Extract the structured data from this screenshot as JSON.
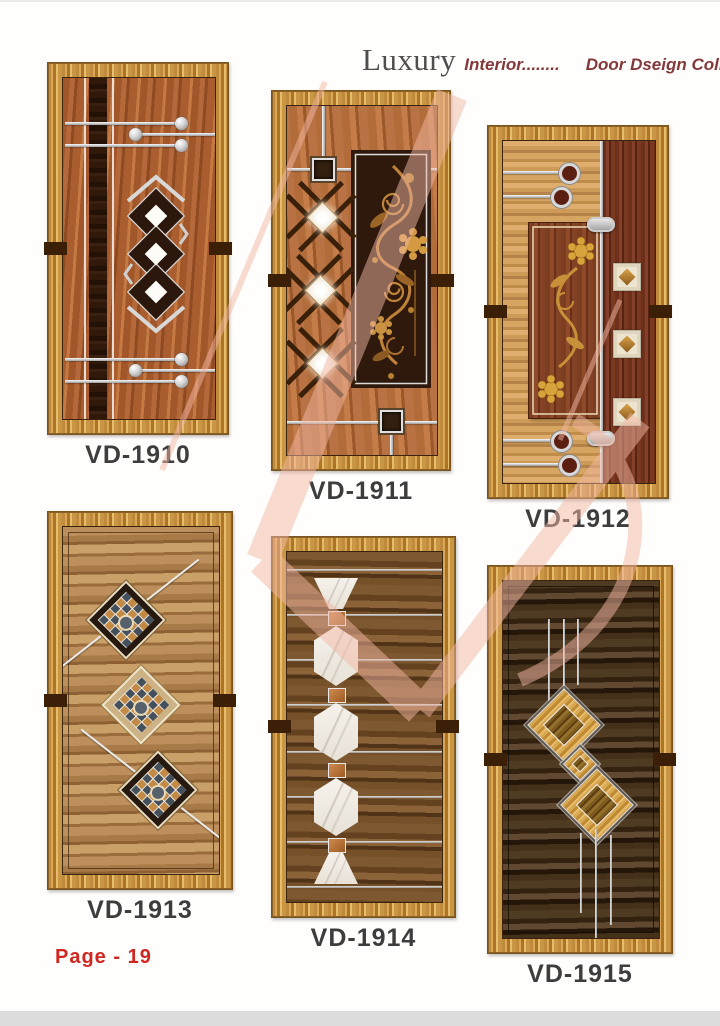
{
  "header": {
    "brand": "Luxury",
    "tagline": "Interior........",
    "collection": "Door Dseign Collecation...."
  },
  "doors": [
    {
      "code": "VD-1910"
    },
    {
      "code": "VD-1911"
    },
    {
      "code": "VD-1912"
    },
    {
      "code": "VD-1913"
    },
    {
      "code": "VD-1914"
    },
    {
      "code": "VD-1915"
    }
  ],
  "footer": {
    "page_label": "Page - 19"
  },
  "colors": {
    "frame_gold": "#c99a45",
    "label_text": "#3d3d3d",
    "page_red": "#d02820",
    "header_maroon": "#83383a",
    "header_gray": "#4e4e4e",
    "watermark_pink": "#f2b7a3"
  }
}
